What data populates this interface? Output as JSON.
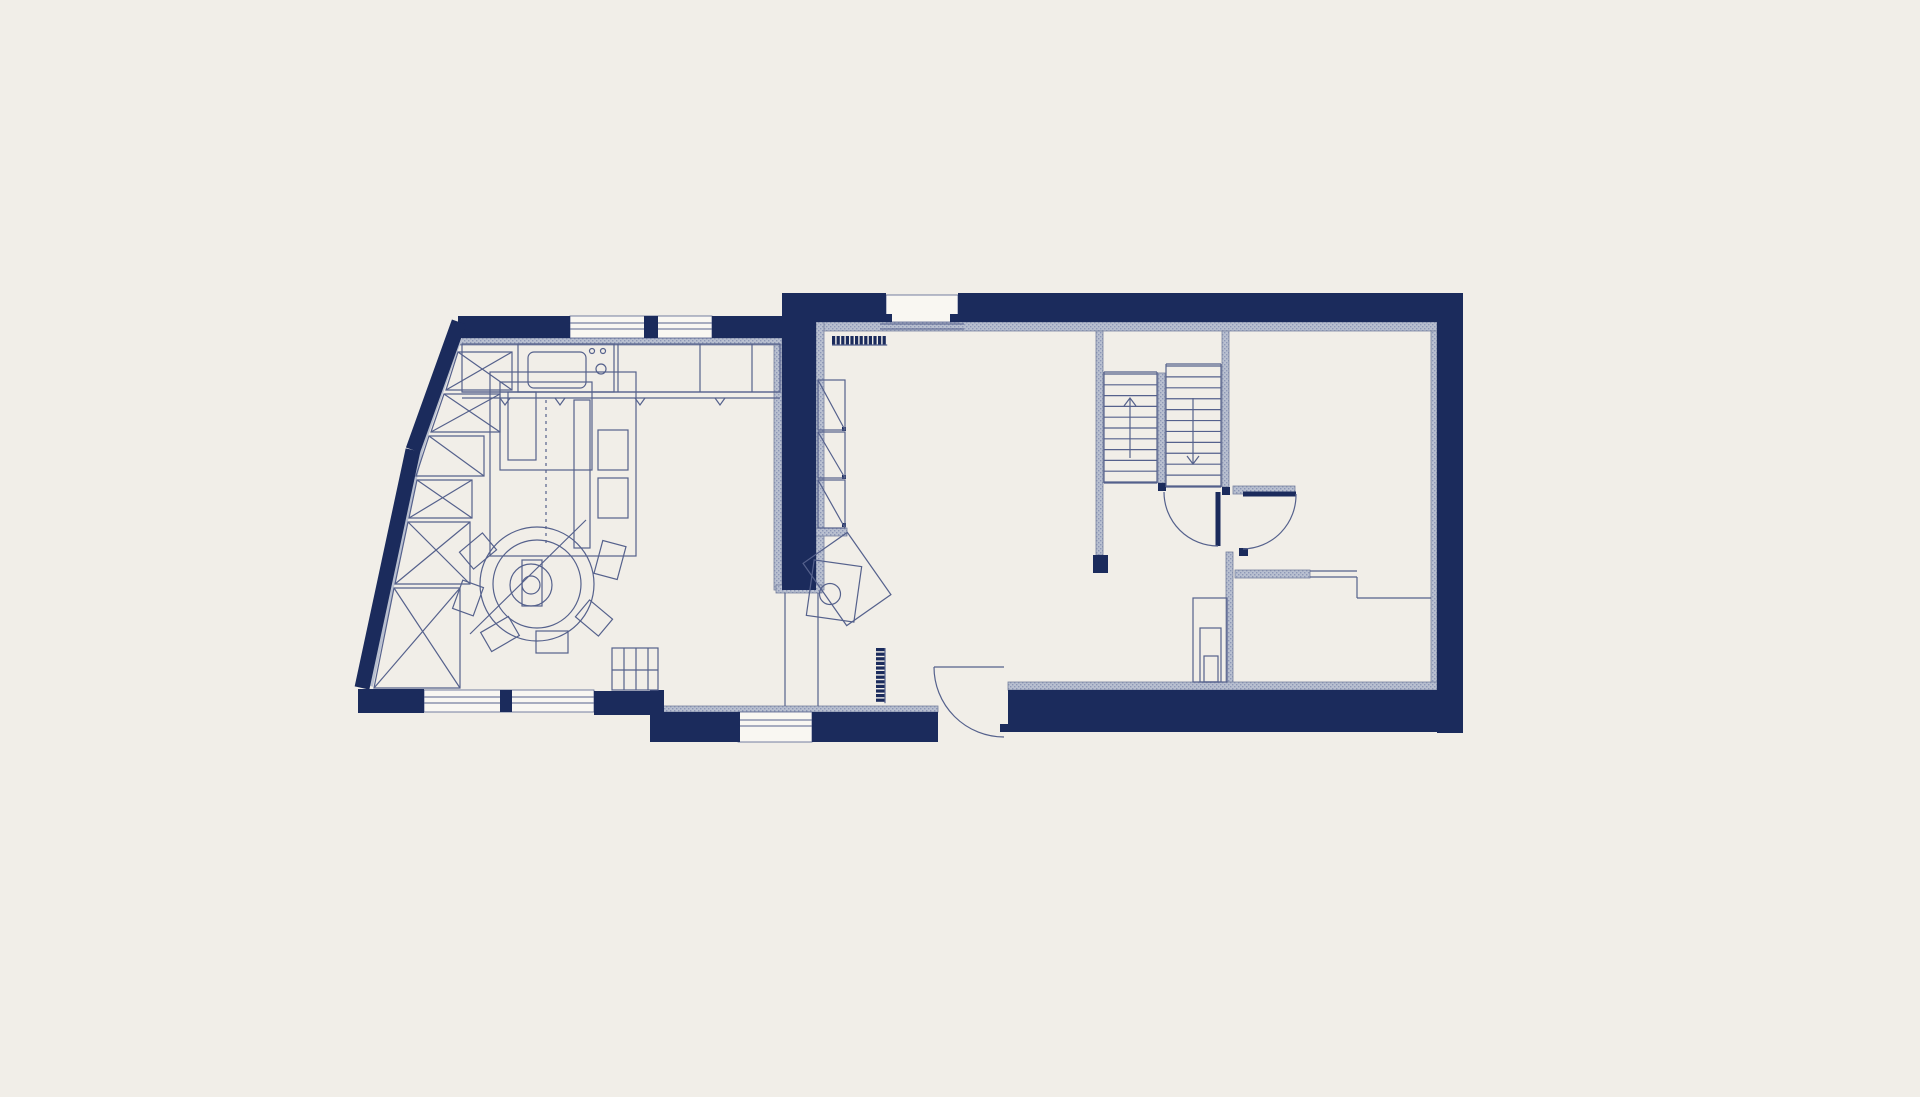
{
  "meta": {
    "title": "architectural-floor-plan",
    "canvas": {
      "w": 1920,
      "h": 1097
    }
  },
  "colors": {
    "background": "#f1eee8",
    "wall_navy": "#1b2b5c",
    "hatch_fill": "#b9c0d0",
    "hatch_stroke": "#77819f",
    "thin_line": "#55618c",
    "faint_line": "#7b85a8",
    "window_fill": "#f9f7f2"
  },
  "plan": {
    "hatch_rects": [
      {
        "name": "lining-top-right",
        "x": 816,
        "y": 322,
        "w": 621,
        "h": 9
      },
      {
        "name": "lining-middle-left",
        "x": 774,
        "y": 331,
        "w": 8,
        "h": 259
      },
      {
        "name": "lining-middle-right",
        "x": 816,
        "y": 322,
        "w": 8,
        "h": 268
      },
      {
        "name": "middle-wall-cap",
        "x": 776,
        "y": 585,
        "w": 46,
        "h": 8
      },
      {
        "name": "lining-top-left",
        "x": 460,
        "y": 338,
        "w": 322,
        "h": 7
      },
      {
        "name": "lining-right-inner",
        "x": 1431,
        "y": 331,
        "w": 6,
        "h": 359
      },
      {
        "name": "stair-wall-left",
        "x": 1096,
        "y": 331,
        "w": 7,
        "h": 224
      },
      {
        "name": "stair-wall-mid",
        "x": 1158,
        "y": 373,
        "w": 7,
        "h": 110
      },
      {
        "name": "stair-wall-right",
        "x": 1222,
        "y": 331,
        "w": 7,
        "h": 156
      },
      {
        "name": "room2-wall-left",
        "x": 1226,
        "y": 552,
        "w": 7,
        "h": 138
      },
      {
        "name": "room2-top-wall",
        "x": 1233,
        "y": 486,
        "w": 62,
        "h": 8
      },
      {
        "name": "room2-partition",
        "x": 1235,
        "y": 570,
        "w": 75,
        "h": 8
      },
      {
        "name": "lining-bottom-right",
        "x": 1008,
        "y": 682,
        "w": 429,
        "h": 8
      },
      {
        "name": "lining-bottom-mid",
        "x": 660,
        "y": 706,
        "w": 278,
        "h": 6
      },
      {
        "name": "lining-bottom-left-a",
        "x": 360,
        "y": 690,
        "w": 64,
        "h": 6
      },
      {
        "name": "lining-bottom-left-b",
        "x": 594,
        "y": 694,
        "w": 66,
        "h": 6
      },
      {
        "name": "cabinet-cap-right",
        "x": 816,
        "y": 528,
        "w": 31,
        "h": 8
      }
    ],
    "hatch_lines": [
      {
        "name": "left-wall-lining-upper",
        "x1": 464,
        "y1": 324,
        "x2": 420,
        "y2": 450,
        "w": 6
      },
      {
        "name": "left-wall-lining-lower",
        "x1": 420,
        "y1": 450,
        "x2": 370,
        "y2": 686,
        "w": 6
      }
    ],
    "windows": [
      {
        "name": "window-top-left",
        "x": 570,
        "y": 316,
        "w": 142,
        "h": 22
      },
      {
        "name": "window-top-right",
        "x": 886,
        "y": 295,
        "w": 72,
        "h": 27
      },
      {
        "name": "window-bottom-left",
        "x": 424,
        "y": 690,
        "w": 170,
        "h": 22
      },
      {
        "name": "window-bottom-mid",
        "x": 738,
        "y": 712,
        "w": 74,
        "h": 30
      }
    ],
    "navy_rects": [
      {
        "name": "top-wall-right-a",
        "x": 798,
        "y": 293,
        "w": 88,
        "h": 29
      },
      {
        "name": "top-wall-right-b",
        "x": 958,
        "y": 293,
        "w": 505,
        "h": 29
      },
      {
        "name": "outer-wall-right",
        "x": 1437,
        "y": 293,
        "w": 26,
        "h": 440
      },
      {
        "name": "bottom-wall-right",
        "x": 1008,
        "y": 690,
        "w": 455,
        "h": 42
      },
      {
        "name": "bottom-wall-mid-a",
        "x": 652,
        "y": 712,
        "w": 88,
        "h": 30
      },
      {
        "name": "bottom-wall-mid-b",
        "x": 812,
        "y": 712,
        "w": 126,
        "h": 30
      },
      {
        "name": "bottom-step-junction",
        "x": 650,
        "y": 690,
        "w": 14,
        "h": 52
      },
      {
        "name": "middle-wall",
        "x": 782,
        "y": 293,
        "w": 34,
        "h": 297
      },
      {
        "name": "top-wall-left-a",
        "x": 458,
        "y": 316,
        "w": 112,
        "h": 22
      },
      {
        "name": "top-window-mullion",
        "x": 644,
        "y": 316,
        "w": 14,
        "h": 22
      },
      {
        "name": "top-wall-left-b",
        "x": 712,
        "y": 316,
        "w": 88,
        "h": 22
      },
      {
        "name": "bottom-window-mullion",
        "x": 500,
        "y": 690,
        "w": 12,
        "h": 22
      },
      {
        "name": "stair-wall-end-block",
        "x": 1093,
        "y": 555,
        "w": 15,
        "h": 18
      },
      {
        "name": "stair-mid-block",
        "x": 1158,
        "y": 483,
        "w": 8,
        "h": 8
      },
      {
        "name": "stair-door-jamb",
        "x": 1222,
        "y": 487,
        "w": 8,
        "h": 8
      },
      {
        "name": "room2-door-jamb",
        "x": 1239,
        "y": 548,
        "w": 9,
        "h": 8
      },
      {
        "name": "ext-door-jamb-a",
        "x": 930,
        "y": 712,
        "w": 8,
        "h": 8
      },
      {
        "name": "ext-door-jamb-b",
        "x": 1000,
        "y": 724,
        "w": 8,
        "h": 8
      },
      {
        "name": "window-hook-a",
        "x": 884,
        "y": 314,
        "w": 8,
        "h": 8
      },
      {
        "name": "window-hook-b",
        "x": 950,
        "y": 314,
        "w": 8,
        "h": 8
      },
      {
        "name": "cabinet-hinge-dot-1",
        "x": 842,
        "y": 427,
        "w": 4,
        "h": 4
      },
      {
        "name": "cabinet-hinge-dot-2",
        "x": 842,
        "y": 475,
        "w": 4,
        "h": 4
      },
      {
        "name": "cabinet-hinge-dot-3",
        "x": 842,
        "y": 523,
        "w": 4,
        "h": 4
      }
    ],
    "navy_lines": [
      {
        "name": "left-wall-upper",
        "x1": 459,
        "y1": 322,
        "x2": 413,
        "y2": 450,
        "w": 15
      },
      {
        "name": "left-wall-lower",
        "x1": 413,
        "y1": 450,
        "x2": 362,
        "y2": 688,
        "w": 15
      },
      {
        "name": "bottom-wall-left-a",
        "x1": 358,
        "y1": 701,
        "x2": 424,
        "y2": 701,
        "w": 24
      },
      {
        "name": "bottom-wall-left-b",
        "x1": 594,
        "y1": 703,
        "x2": 660,
        "y2": 703,
        "w": 24
      },
      {
        "name": "stair-door-leaf",
        "x1": 1218,
        "y1": 492,
        "x2": 1218,
        "y2": 546,
        "w": 5
      },
      {
        "name": "room2-door-leaf",
        "x1": 1243,
        "y1": 494,
        "x2": 1296,
        "y2": 494,
        "w": 5
      }
    ],
    "window_lines": [
      {
        "name": "sill-top-left-1",
        "x1": 570,
        "y1": 323,
        "x2": 712,
        "y2": 323
      },
      {
        "name": "sill-top-left-2",
        "x1": 570,
        "y1": 329,
        "x2": 712,
        "y2": 329
      },
      {
        "name": "sill-top-right-1",
        "x1": 880,
        "y1": 324,
        "x2": 964,
        "y2": 324
      },
      {
        "name": "sill-top-right-2",
        "x1": 880,
        "y1": 329,
        "x2": 964,
        "y2": 329
      },
      {
        "name": "sill-bottom-left-1",
        "x1": 424,
        "y1": 697,
        "x2": 594,
        "y2": 697
      },
      {
        "name": "sill-bottom-left-2",
        "x1": 424,
        "y1": 703,
        "x2": 594,
        "y2": 703
      },
      {
        "name": "sill-bottom-mid-1",
        "x1": 738,
        "y1": 720,
        "x2": 812,
        "y2": 720
      },
      {
        "name": "sill-bottom-mid-2",
        "x1": 738,
        "y1": 726,
        "x2": 812,
        "y2": 726
      }
    ],
    "thin_lines": [
      {
        "name": "counter-edge-1",
        "x1": 462,
        "y1": 392,
        "x2": 780,
        "y2": 392
      },
      {
        "name": "counter-edge-2",
        "x1": 462,
        "y1": 398,
        "x2": 780,
        "y2": 398
      },
      {
        "name": "counter-divider-1",
        "x1": 618,
        "y1": 344,
        "x2": 618,
        "y2": 392
      },
      {
        "name": "counter-divider-2",
        "x1": 700,
        "y1": 344,
        "x2": 700,
        "y2": 392
      },
      {
        "name": "counter-divider-3",
        "x1": 752,
        "y1": 344,
        "x2": 752,
        "y2": 392
      },
      {
        "name": "opening-line-a",
        "x1": 785,
        "y1": 593,
        "x2": 785,
        "y2": 706
      },
      {
        "name": "opening-line-b",
        "x1": 818,
        "y1": 593,
        "x2": 818,
        "y2": 706
      },
      {
        "name": "room2-glass-1",
        "x1": 1310,
        "y1": 571,
        "x2": 1357,
        "y2": 571
      },
      {
        "name": "room2-glass-2",
        "x1": 1310,
        "y1": 577,
        "x2": 1357,
        "y2": 577
      },
      {
        "name": "room2-step-v",
        "x1": 1357,
        "y1": 577,
        "x2": 1357,
        "y2": 598
      },
      {
        "name": "room2-step-h",
        "x1": 1357,
        "y1": 598,
        "x2": 1431,
        "y2": 598
      },
      {
        "name": "ext-door-chord",
        "x1": 934,
        "y1": 667,
        "x2": 1004,
        "y2": 667
      },
      {
        "name": "stair-left-edge-a",
        "x1": 1104,
        "y1": 372,
        "x2": 1104,
        "y2": 483
      },
      {
        "name": "stair-left-edge-b",
        "x1": 1157,
        "y1": 372,
        "x2": 1157,
        "y2": 483
      },
      {
        "name": "stair-left-top",
        "x1": 1104,
        "y1": 372,
        "x2": 1157,
        "y2": 372
      },
      {
        "name": "stair-left-bottom",
        "x1": 1104,
        "y1": 483,
        "x2": 1157,
        "y2": 483
      },
      {
        "name": "stair-right-edge-a",
        "x1": 1166,
        "y1": 364,
        "x2": 1166,
        "y2": 487
      },
      {
        "name": "stair-right-edge-b",
        "x1": 1221,
        "y1": 364,
        "x2": 1221,
        "y2": 487
      },
      {
        "name": "stair-right-top",
        "x1": 1166,
        "y1": 364,
        "x2": 1221,
        "y2": 364
      },
      {
        "name": "stair-right-bottom",
        "x1": 1166,
        "y1": 487,
        "x2": 1221,
        "y2": 487
      },
      {
        "name": "sofa-diagonal",
        "x1": 470,
        "y1": 634,
        "x2": 586,
        "y2": 520
      },
      {
        "name": "gridbox-v1",
        "x1": 624,
        "y1": 648,
        "x2": 624,
        "y2": 690
      },
      {
        "name": "gridbox-v2",
        "x1": 636,
        "y1": 648,
        "x2": 636,
        "y2": 690
      },
      {
        "name": "gridbox-v3",
        "x1": 648,
        "y1": 648,
        "x2": 648,
        "y2": 690
      },
      {
        "name": "gridbox-h",
        "x1": 612,
        "y1": 670,
        "x2": 658,
        "y2": 670
      }
    ],
    "dashed_lines": [
      {
        "name": "furniture-dashed",
        "x1": 546,
        "y1": 400,
        "x2": 546,
        "y2": 545
      }
    ],
    "thin_rects": [
      {
        "name": "kitchen-counter",
        "x": 462,
        "y": 344,
        "w": 318,
        "h": 48
      },
      {
        "name": "sink-unit",
        "x": 518,
        "y": 344,
        "w": 96,
        "h": 48
      },
      {
        "name": "sink-basin",
        "x": 528,
        "y": 352,
        "w": 58,
        "h": 36,
        "rx": 6
      },
      {
        "name": "grid-box",
        "x": 612,
        "y": 648,
        "w": 46,
        "h": 42
      },
      {
        "name": "island-outline",
        "x": 490,
        "y": 372,
        "w": 146,
        "h": 184
      },
      {
        "name": "island-inner-a",
        "x": 500,
        "y": 382,
        "w": 92,
        "h": 88
      },
      {
        "name": "island-inner-b",
        "x": 508,
        "y": 392,
        "w": 28,
        "h": 68
      },
      {
        "name": "island-rail",
        "x": 574,
        "y": 400,
        "w": 16,
        "h": 148
      },
      {
        "name": "island-box-a",
        "x": 598,
        "y": 430,
        "w": 30,
        "h": 40
      },
      {
        "name": "island-box-b",
        "x": 598,
        "y": 478,
        "w": 30,
        "h": 40
      },
      {
        "name": "round-table-base",
        "x": 522,
        "y": 560,
        "w": 20,
        "h": 46
      },
      {
        "name": "corner-furniture-outer",
        "x": 1193,
        "y": 598,
        "w": 34,
        "h": 84
      },
      {
        "name": "corner-furniture-mid",
        "x": 1200,
        "y": 628,
        "w": 21,
        "h": 54
      },
      {
        "name": "corner-furniture-inner",
        "x": 1204,
        "y": 656,
        "w": 14,
        "h": 26
      },
      {
        "name": "tall-cabinet-1",
        "x": 818,
        "y": 380,
        "w": 27,
        "h": 50,
        "diag": true
      },
      {
        "name": "tall-cabinet-2",
        "x": 818,
        "y": 432,
        "w": 27,
        "h": 46,
        "diag": true
      },
      {
        "name": "tall-cabinet-3",
        "x": 818,
        "y": 480,
        "w": 27,
        "h": 48,
        "diag": true
      }
    ],
    "polygons": [
      {
        "name": "wall-cabinet-1",
        "points": [
          [
            458,
            352
          ],
          [
            512,
            352
          ],
          [
            512,
            390
          ],
          [
            446,
            390
          ]
        ],
        "cross": true
      },
      {
        "name": "wall-cabinet-2",
        "points": [
          [
            444,
            394
          ],
          [
            500,
            394
          ],
          [
            500,
            432
          ],
          [
            431,
            432
          ]
        ],
        "cross": true
      },
      {
        "name": "wall-cabinet-3",
        "points": [
          [
            429,
            436
          ],
          [
            484,
            436
          ],
          [
            484,
            476
          ],
          [
            416,
            476
          ]
        ],
        "diag": true
      },
      {
        "name": "wall-cabinet-4",
        "points": [
          [
            417,
            480
          ],
          [
            472,
            480
          ],
          [
            472,
            518
          ],
          [
            409,
            518
          ]
        ],
        "cross": true
      },
      {
        "name": "wall-cabinet-5",
        "points": [
          [
            408,
            522
          ],
          [
            470,
            522
          ],
          [
            470,
            584
          ],
          [
            395,
            584
          ]
        ],
        "cross": true
      },
      {
        "name": "wall-cabinet-6",
        "points": [
          [
            394,
            588
          ],
          [
            460,
            588
          ],
          [
            460,
            688
          ],
          [
            374,
            688
          ]
        ],
        "cross": true
      }
    ],
    "rot_rects": [
      {
        "name": "stove-square-a",
        "cx": 847,
        "cy": 579,
        "w": 54,
        "h": 76,
        "angle": -35
      },
      {
        "name": "stove-square-b",
        "cx": 834,
        "cy": 591,
        "w": 48,
        "h": 56,
        "angle": 8
      },
      {
        "name": "chair-1",
        "cx": 478,
        "cy": 551,
        "w": 30,
        "h": 22,
        "angle": -40
      },
      {
        "name": "chair-2",
        "cx": 468,
        "cy": 598,
        "w": 30,
        "h": 22,
        "angle": -70
      },
      {
        "name": "chair-3",
        "cx": 500,
        "cy": 634,
        "w": 32,
        "h": 22,
        "angle": -30
      },
      {
        "name": "chair-4",
        "cx": 552,
        "cy": 642,
        "w": 32,
        "h": 22,
        "angle": 0
      },
      {
        "name": "chair-5",
        "cx": 594,
        "cy": 618,
        "w": 30,
        "h": 22,
        "angle": 40
      },
      {
        "name": "chair-6",
        "cx": 610,
        "cy": 560,
        "w": 24,
        "h": 34,
        "angle": 15
      }
    ],
    "circles": [
      {
        "name": "faucet",
        "cx": 601,
        "cy": 369,
        "r": 5
      },
      {
        "name": "tap-dot-a",
        "cx": 592,
        "cy": 351,
        "r": 2.5
      },
      {
        "name": "tap-dot-b",
        "cx": 603,
        "cy": 351,
        "r": 2.5
      },
      {
        "name": "round-arc-outer",
        "cx": 537,
        "cy": 584,
        "r": 57
      },
      {
        "name": "round-arc-inner",
        "cx": 537,
        "cy": 584,
        "r": 44
      },
      {
        "name": "round-seat",
        "cx": 531,
        "cy": 585,
        "r": 21
      },
      {
        "name": "round-seat-core",
        "cx": 531,
        "cy": 585,
        "r": 9
      },
      {
        "name": "stove-flue",
        "cx": 830,
        "cy": 594,
        "r": 10.5
      }
    ],
    "paths": [
      {
        "name": "stair-door-arc",
        "d": "M1164,492 A54,54 0 0 0 1218,546"
      },
      {
        "name": "room2-door-arc",
        "d": "M1296,494 A54,54 0 0 1 1243,549"
      },
      {
        "name": "exterior-door-arc",
        "d": "M934,667 A70,70 0 0 0 1004,737"
      }
    ],
    "stairs": [
      {
        "name": "stair-flight-up",
        "x": 1104,
        "w": 53,
        "y0": 374,
        "y1": 482,
        "count": 11
      },
      {
        "name": "stair-flight-down",
        "x": 1166,
        "w": 55,
        "y0": 366,
        "y1": 486,
        "count": 12
      }
    ],
    "arrows": [
      {
        "name": "stair-arrow-up",
        "x": 1130,
        "yTail": 458,
        "yHead": 398,
        "dir": "up"
      },
      {
        "name": "stair-arrow-down",
        "x": 1193,
        "yTail": 398,
        "yHead": 464,
        "dir": "down"
      }
    ],
    "teeth": [
      {
        "name": "radiator-top",
        "x": 832,
        "y": 336,
        "count": 12,
        "step": 4.6,
        "tw": 3.2,
        "th": 9,
        "orient": "h"
      },
      {
        "name": "radiator-side",
        "x": 876,
        "y": 648,
        "count": 12,
        "step": 4.6,
        "tw": 9,
        "th": 3.2,
        "orient": "v"
      }
    ],
    "vees": [
      {
        "name": "hook-1",
        "x": 505,
        "y": 398
      },
      {
        "name": "hook-2",
        "x": 560,
        "y": 398
      },
      {
        "name": "hook-3",
        "x": 640,
        "y": 398
      },
      {
        "name": "hook-4",
        "x": 720,
        "y": 398
      }
    ]
  }
}
